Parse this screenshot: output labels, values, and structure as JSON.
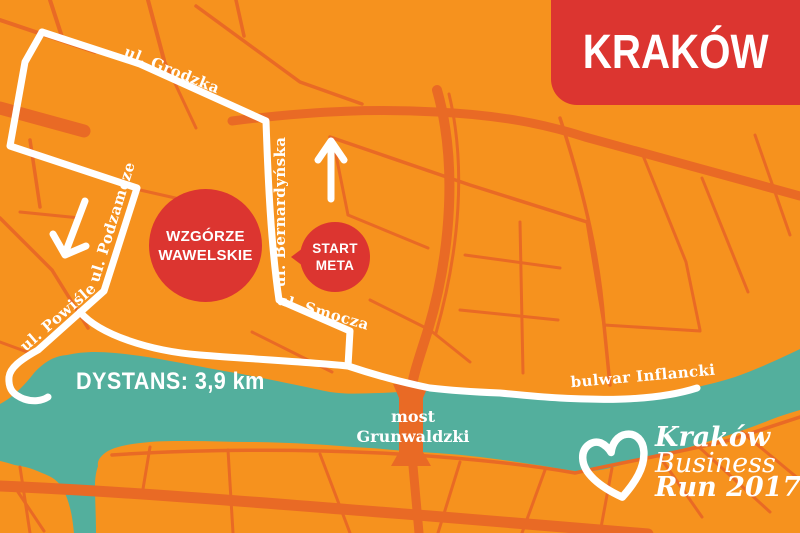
{
  "banner": {
    "title": "KRAKÓW"
  },
  "streets": {
    "grodzka": "ul. Grodzka",
    "podzamcze": "ul. Podzamcze",
    "powisle": "ul. Powiśle",
    "bernardynska": "ul. Bernardyńska",
    "smocza": "ul. Smocza",
    "inflancki": "bulwar Inflancki"
  },
  "bridge": {
    "line1": "most",
    "line2": "Grunwaldzki"
  },
  "markers": {
    "wawel": {
      "line1": "WZGÓRZE",
      "line2": "WAWELSKIE"
    },
    "startmeta": {
      "line1": "START",
      "line2": "META"
    }
  },
  "route": {
    "distance_label": "DYSTANS: 3,9 km"
  },
  "logo": {
    "line1": "Kraków",
    "line2": "Business",
    "line3": "Run 2017"
  },
  "colors": {
    "background_orange": "#F6921E",
    "street_orange": "#E96A25",
    "river_teal": "#53AF9D",
    "accent_red": "#DC3530",
    "text_white": "#FFFFFF"
  }
}
